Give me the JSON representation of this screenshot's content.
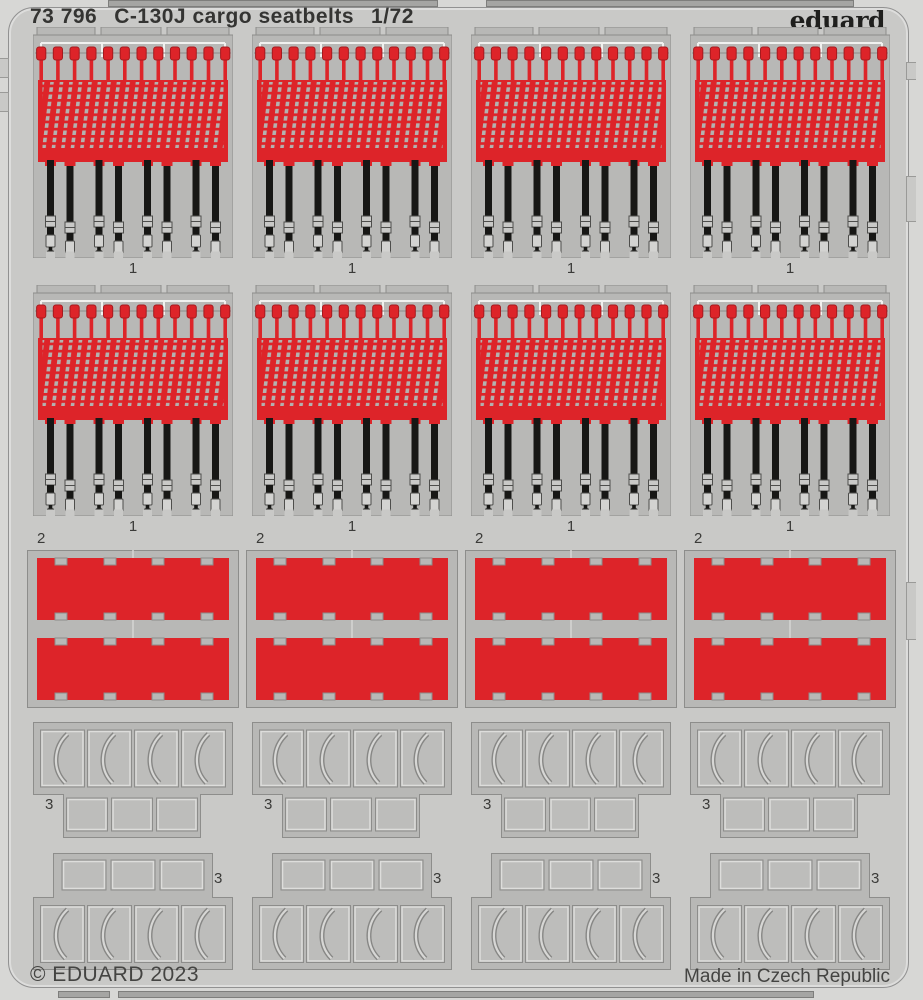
{
  "header": {
    "catalog_number": "73 796",
    "title": "C-130J cargo seatbelts",
    "scale": "1/72",
    "brand": "eduard"
  },
  "part_numbers": {
    "seatbelt_assembly": "1",
    "red_panel": "2",
    "frame_section": "3"
  },
  "parts_inventory": [
    {
      "part_number": "1",
      "pieces": 8,
      "description": "red cargo net with black seatbelt straps"
    },
    {
      "part_number": "2",
      "pieces": 8,
      "description": "plain red rectangular panel"
    },
    {
      "part_number": "3",
      "pieces": 8,
      "description": "grey frame section with curved detail"
    }
  ],
  "footer": {
    "copyright": "© EDUARD 2023",
    "made_in": "Made in Czech Republic"
  },
  "colors": {
    "red": "#dd2429",
    "reddark": "#a61a1e",
    "belt": "#171715",
    "plate": "#b8b8b6",
    "plate2": "#b4b2b0",
    "pedge": "#8d8d8b",
    "sheet": "#c9c9c7",
    "outer": "#d7d7d5",
    "bar": "#a5a5a3",
    "text": "#343432"
  }
}
